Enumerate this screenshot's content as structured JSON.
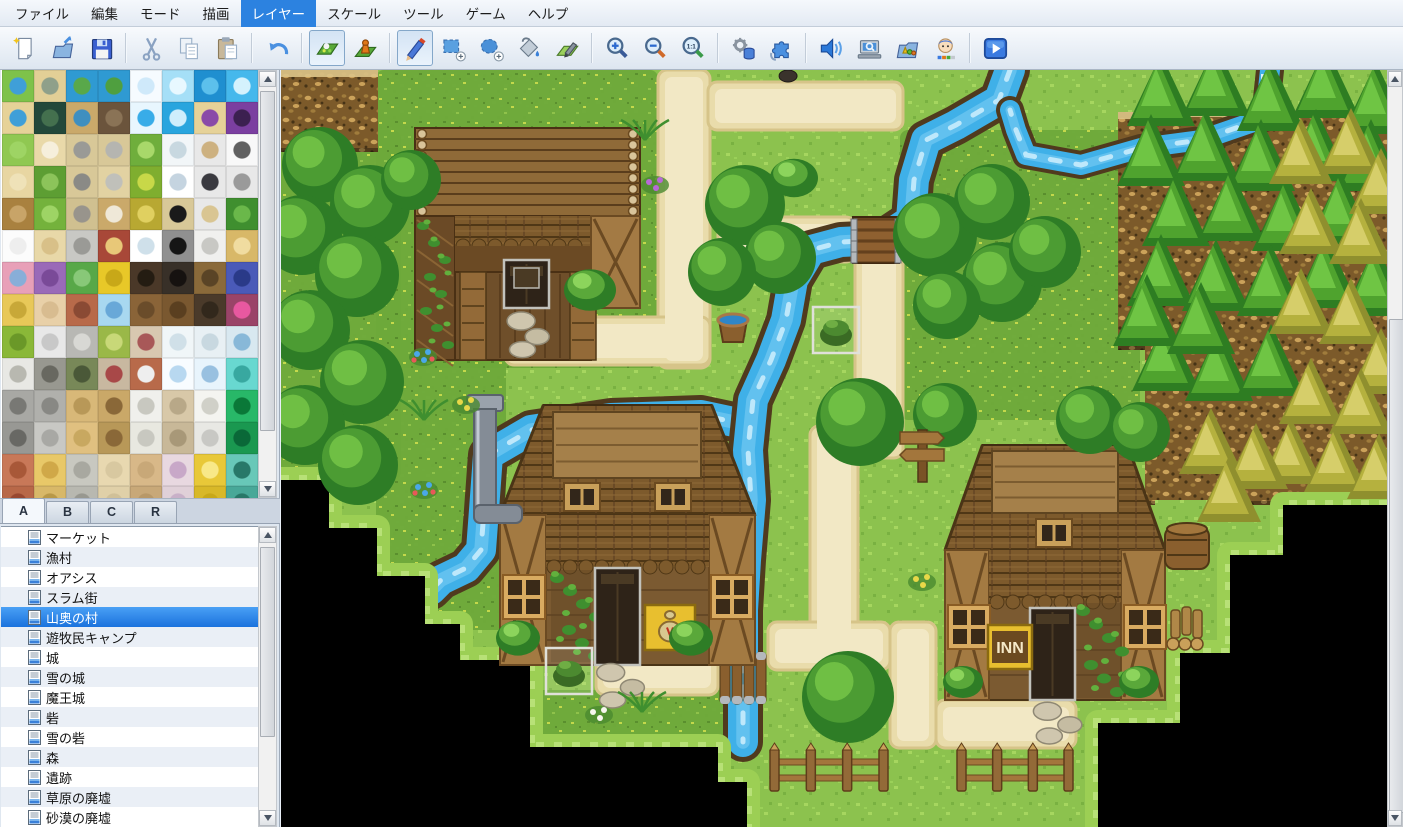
{
  "menu": {
    "items": [
      {
        "label": "ファイル",
        "active": false
      },
      {
        "label": "編集",
        "active": false
      },
      {
        "label": "モード",
        "active": false
      },
      {
        "label": "描画",
        "active": false
      },
      {
        "label": "レイヤー",
        "active": true
      },
      {
        "label": "スケール",
        "active": false
      },
      {
        "label": "ツール",
        "active": false
      },
      {
        "label": "ゲーム",
        "active": false
      },
      {
        "label": "ヘルプ",
        "active": false
      }
    ]
  },
  "toolbar": {
    "groups": [
      [
        "new-project",
        "open-project",
        "save-project"
      ],
      [
        "cut",
        "copy",
        "paste"
      ],
      [
        "undo"
      ],
      [
        "map-mode",
        "event-mode"
      ],
      [
        "pencil",
        "rect-select",
        "ellipse-select",
        "flood-fill",
        "shadow-pen"
      ],
      [
        "zoom-in",
        "zoom-out",
        "zoom-actual"
      ],
      [
        "database",
        "plugin-manager"
      ],
      [
        "sound-test",
        "event-search",
        "resource-manager",
        "character-generator"
      ],
      [
        "playtest"
      ]
    ],
    "pressed": [
      "map-mode",
      "pencil"
    ],
    "accent_color": "#2c82e0"
  },
  "palette": {
    "tabs": [
      {
        "label": "A",
        "active": true
      },
      {
        "label": "B",
        "active": false
      },
      {
        "label": "C",
        "active": false
      },
      {
        "label": "R",
        "active": false
      }
    ],
    "tiles": [
      [
        "#7ec24a|#3f9fd8",
        "#e2cf96|#8fa08a",
        "#2f9ad2|#59a84a",
        "#2f9ad2|#4f9f3f",
        "#f6fbff|#cfe9fa",
        "#a5dff7|#e8f8ff",
        "#1f8fd0|#5cc0ec",
        "#45b8ec|#d4f2fd"
      ],
      [
        "#e6d298|#3f9fd8",
        "#23483a|#44704e",
        "#caa96a|#3f8fc0",
        "#6b543c|#8a7356",
        "#e8f6fe|#38ace8",
        "#29a5de|#cfeefc",
        "#e6d298|#8a4aa8",
        "#7b3fa0|#3c2050"
      ],
      [
        "#90c852|#9ed464",
        "#e9d9a9|#f6efdc",
        "#d8c898|#9a9a96",
        "#d8c898|#b5b5b0",
        "#6fae3c|#a8d86a",
        "#f2f6f8|#c8d8e0",
        "#e8e8e8|#cdb180",
        "#f8f8f8|#606060"
      ],
      [
        "#e8d6a2|#efe2b8",
        "#5d9e33|#8cc45a",
        "#d8c898|#8a8a86",
        "#e2d2a2|#c0c0ba",
        "#7fae2f|#c8d848",
        "#ffffff|#c5d4e0",
        "#e8e8e8|#3a3a40",
        "#e8e8e8|#9a9a9a"
      ],
      [
        "#a9813f|#c8a468",
        "#74b23c|#9ed465",
        "#d0c090|#98948c",
        "#caa96a|#efe8d8",
        "#b8a832|#e0d060",
        "#d8c898|#1a1a1a",
        "#e8e8e8|#d9c592",
        "#3f8f2f|#6ab84a"
      ],
      [
        "#fcfcfc|#eeeeee",
        "#e8d8a8|#d8c088",
        "#c8c8c4|#9a9a96",
        "#a84838|#e8c878",
        "#ffffff|#cfe0ea",
        "#909090|#151515",
        "#f0f0ee|#c8c8c4",
        "#d8b868|#f0dca0"
      ],
      [
        "#e8a0b8|#88aed8",
        "#9a6ab8|#7a4a98",
        "#58a848|#88c878",
        "#e8c828|#c8a818",
        "#4a3828|#241c12",
        "#383028|#161210",
        "#8a6a3a|#5a4426",
        "#4a5ab8|#2a3a88"
      ],
      [
        "#e8c858|#c8a838",
        "#e8d0a8|#d8bc90",
        "#b86a4a|#8a4a34",
        "#a8d8f0|#68a8d8",
        "#8a6438|#6a4c2a",
        "#7a5830|#5a3f20",
        "#4a3a2a|#32281c",
        "#9a4468|#e858a0"
      ],
      [
        "#8ab838|#6a9828",
        "#e8e8e8|#c8c8c8",
        "#b8b8b4|#d8d8d4",
        "#9ab848|#c8d878",
        "#d8c8b0|#a85858",
        "#f0f6f8|#d0e0e8",
        "#e8f0f4|#c8d8e0",
        "#d8e8f0|#88b8d8"
      ],
      [
        "#e8e8e4|#b8b8b0",
        "#989890|#686860",
        "#788858|#4a5838",
        "#c8b8a0|#a84848",
        "#b86a4a|#eeeeee",
        "#f8fcff|#b8d8f0",
        "#e8f4fc|#98c0e0",
        "#68d8d0|#38a8a0"
      ],
      [
        "#a8a8a4|#787874",
        "#b0b0ac|#888884",
        "#d8b878|#b89858",
        "#caa868|#8a6838",
        "#f0f0ec|#c8c8c0",
        "#d8c8a8|#b8a888",
        "#f4f4f0|#d0d0c8",
        "#28b868|#0a7838"
      ],
      [
        "#989894|#686864",
        "#c8c8c4|#a8a8a4",
        "#e0c080|#c8a860",
        "#b89858|#8a6838",
        "#e8e8e0|#c8c8c0",
        "#c8b898|#a89878",
        "#e8e8e4|#c8c8c4",
        "#1a9850|#0a6838"
      ],
      [
        "#c87858|#a85838",
        "#e8c868|#d0a848",
        "#c8c8c0|#a8a8a0",
        "#e8d8b0|#d8c8a0",
        "#d8b888|#c8a878",
        "#e8d8e0|#c8a8c8",
        "#e8c838|#f8e888",
        "#68c8b8|#287868"
      ],
      [
        "#b86848|#984830",
        "#d8b868|#b89848",
        "#b8b8b0|#989890",
        "#e0d0a8|#d0c098",
        "#c8a878|#b89868",
        "#e0d0d8|#c8b0c8",
        "#d8b828|#c8a818",
        "#48a898|#287868"
      ]
    ]
  },
  "map_list": {
    "items": [
      {
        "label": "マーケット",
        "selected": false
      },
      {
        "label": "漁村",
        "selected": false
      },
      {
        "label": "オアシス",
        "selected": false
      },
      {
        "label": "スラム街",
        "selected": false
      },
      {
        "label": "山奥の村",
        "selected": true
      },
      {
        "label": "遊牧民キャンプ",
        "selected": false
      },
      {
        "label": "城",
        "selected": false
      },
      {
        "label": "雪の城",
        "selected": false
      },
      {
        "label": "魔王城",
        "selected": false
      },
      {
        "label": "砦",
        "selected": false
      },
      {
        "label": "雪の砦",
        "selected": false
      },
      {
        "label": "森",
        "selected": false
      },
      {
        "label": "遺跡",
        "selected": false
      },
      {
        "label": "草原の廃墟",
        "selected": false
      },
      {
        "label": "砂漠の廃墟",
        "selected": false
      }
    ]
  },
  "canvas": {
    "current_map": "山奥の村",
    "scene": {
      "colors": {
        "grass": "#8cc24e",
        "meadow": "#6da93a",
        "path": "#e9dcab",
        "path_light": "#f2e8c5",
        "water": "#3fb0e8",
        "bank": "#503a1e",
        "cliff": "#7c5a2a",
        "black": "#000000"
      },
      "meadows": [
        [
          95,
          0,
          282,
          298
        ],
        [
          95,
          270,
          130,
          290
        ],
        [
          250,
          620,
          215,
          57
        ],
        [
          619,
          60,
          240,
          290
        ],
        [
          874,
          525,
          75,
          58
        ],
        [
          0,
          60,
          120,
          350
        ]
      ],
      "cliffs": [
        [
          0,
          0,
          97,
          82
        ],
        [
          837,
          42,
          42,
          238
        ],
        [
          864,
          40,
          242,
          395
        ]
      ],
      "grass_patches": [
        [
          874,
          430,
          75,
          153
        ]
      ],
      "paths": [
        [
          377,
          0,
          52,
          298
        ],
        [
          427,
          12,
          195,
          48
        ],
        [
          224,
          247,
          205,
          48
        ],
        [
          437,
          147,
          137,
          45
        ],
        [
          574,
          178,
          48,
          210
        ],
        [
          529,
          356,
          48,
          242
        ],
        [
          315,
          577,
          122,
          48
        ],
        [
          487,
          552,
          122,
          48
        ],
        [
          609,
          552,
          46,
          126
        ],
        [
          655,
          630,
          140,
          48
        ]
      ],
      "rivers": {
        "main": [
          [
            729,
            0
          ],
          [
            718,
            30
          ],
          [
            675,
            55
          ],
          [
            645,
            70
          ],
          [
            633,
            110
          ],
          [
            630,
            150
          ],
          [
            600,
            170
          ],
          [
            560,
            172
          ],
          [
            530,
            180
          ],
          [
            512,
            210
          ],
          [
            505,
            250
          ],
          [
            490,
            290
          ],
          [
            472,
            330
          ],
          [
            467,
            380
          ],
          [
            470,
            430
          ],
          [
            465,
            490
          ],
          [
            462,
            540
          ],
          [
            462,
            600
          ],
          [
            462,
            672
          ]
        ],
        "west": [
          [
            467,
            355
          ],
          [
            420,
            345
          ],
          [
            330,
            348
          ],
          [
            250,
            360
          ],
          [
            207,
            385
          ],
          [
            203,
            440
          ],
          [
            200,
            480
          ],
          [
            185,
            498
          ],
          [
            160,
            510
          ],
          [
            150,
            520
          ]
        ],
        "plateau": [
          [
            989,
            0
          ],
          [
            984,
            48
          ],
          [
            920,
            70
          ],
          [
            860,
            78
          ],
          [
            800,
            95
          ],
          [
            745,
            85
          ],
          [
            735,
            60
          ],
          [
            729,
            40
          ]
        ]
      },
      "bridge": [
        572,
        147,
        46,
        46
      ],
      "dam": [
        437,
        582,
        50,
        52
      ],
      "steps_left": [
        [
          0,
          410
        ],
        [
          48,
          410
        ],
        [
          48,
          458
        ],
        [
          96,
          458
        ],
        [
          96,
          506
        ],
        [
          144,
          506
        ],
        [
          144,
          554
        ],
        [
          179,
          554
        ],
        [
          179,
          590
        ],
        [
          249,
          590
        ],
        [
          249,
          677
        ],
        [
          437,
          677
        ],
        [
          437,
          712
        ],
        [
          466,
          712
        ],
        [
          466,
          757
        ]
      ],
      "steps_right": [
        [
          1106,
          435
        ],
        [
          1002,
          435
        ],
        [
          1002,
          485
        ],
        [
          949,
          485
        ],
        [
          949,
          583
        ],
        [
          899,
          583
        ],
        [
          899,
          653
        ],
        [
          817,
          653
        ],
        [
          817,
          757
        ]
      ],
      "houses": [
        {
          "type": "cabin",
          "x": 134,
          "y": 58,
          "w": 225,
          "h": 232,
          "door": [
            223,
            190,
            45,
            48
          ]
        },
        {
          "type": "big",
          "x": 219,
          "y": 335,
          "w": 255,
          "rh": 110,
          "wh": 150,
          "ridge": [
            272,
            342,
            148,
            66
          ],
          "dormers": [
            [
              283,
              413
            ],
            [
              374,
              413
            ]
          ],
          "windows": [
            [
              222,
              505
            ],
            [
              430,
              505
            ]
          ],
          "door": [
            314,
            498,
            45,
            97
          ],
          "sign": {
            "kind": "bag",
            "box": [
              364,
              535,
              50,
              45
            ]
          },
          "vine": [
            270,
            500,
            40,
            92
          ],
          "panels": [
            [
              219,
              445
            ],
            [
              428,
              445
            ]
          ],
          "panelW": 46
        },
        {
          "type": "big",
          "x": 664,
          "y": 375,
          "w": 220,
          "rh": 105,
          "wh": 150,
          "ridge": [
            711,
            381,
            126,
            62
          ],
          "dormers": [
            [
              755,
              449
            ]
          ],
          "windows": [
            [
              667,
              535
            ],
            [
              843,
              535
            ]
          ],
          "door": [
            749,
            538,
            45,
            92
          ],
          "sign": {
            "kind": "text",
            "label": "INN",
            "box": [
              707,
              555,
              44,
              44
            ]
          },
          "vine": [
            796,
            533,
            44,
            95
          ],
          "panels": [
            [
              664,
              480
            ],
            [
              840,
              480
            ]
          ],
          "panelW": 44
        }
      ],
      "trees_round": [
        [
          39,
          95,
          38
        ],
        [
          89,
          135,
          40
        ],
        [
          21,
          165,
          40
        ],
        [
          76,
          205,
          42
        ],
        [
          29,
          260,
          40
        ],
        [
          81,
          312,
          42
        ],
        [
          24,
          355,
          40
        ],
        [
          77,
          395,
          40
        ],
        [
          130,
          110,
          30
        ],
        [
          464,
          135,
          40
        ],
        [
          499,
          188,
          36
        ],
        [
          441,
          202,
          34
        ],
        [
          654,
          165,
          42
        ],
        [
          711,
          132,
          38
        ],
        [
          721,
          212,
          40
        ],
        [
          666,
          235,
          34
        ],
        [
          764,
          182,
          36
        ],
        [
          579,
          352,
          44
        ],
        [
          809,
          350,
          34
        ],
        [
          859,
          362,
          30
        ],
        [
          664,
          345,
          32
        ],
        [
          567,
          627,
          46
        ]
      ],
      "trees_cone": [
        [
          880,
          30
        ],
        [
          935,
          20
        ],
        [
          990,
          35
        ],
        [
          1045,
          22
        ],
        [
          1095,
          38
        ],
        [
          870,
          90
        ],
        [
          925,
          85
        ],
        [
          980,
          95
        ],
        [
          1035,
          85
        ],
        [
          1090,
          95
        ],
        [
          895,
          150
        ],
        [
          950,
          145
        ],
        [
          1005,
          155
        ],
        [
          1060,
          148
        ],
        [
          880,
          210
        ],
        [
          935,
          215
        ],
        [
          990,
          220
        ],
        [
          1045,
          212
        ],
        [
          1095,
          220
        ],
        [
          885,
          295
        ],
        [
          938,
          305
        ],
        [
          990,
          300
        ],
        [
          866,
          250
        ],
        [
          920,
          258
        ]
      ],
      "trees_autumn": [
        [
          1020,
          90
        ],
        [
          1070,
          80
        ],
        [
          1100,
          120
        ],
        [
          1030,
          160
        ],
        [
          1080,
          170
        ],
        [
          1020,
          240
        ],
        [
          1070,
          250
        ],
        [
          1100,
          300
        ],
        [
          1030,
          330
        ],
        [
          1080,
          340
        ],
        [
          1010,
          390
        ],
        [
          1055,
          398
        ],
        [
          1098,
          405
        ],
        [
          930,
          380
        ],
        [
          975,
          395
        ],
        [
          948,
          428
        ]
      ],
      "bushes": [
        [
          237,
          568,
          22
        ],
        [
          410,
          568,
          22
        ],
        [
          682,
          612,
          20
        ],
        [
          858,
          612,
          20
        ],
        [
          513,
          108,
          24
        ],
        [
          309,
          220,
          26
        ]
      ],
      "flowers": [
        {
          "x": 142,
          "y": 287,
          "kind": "blue"
        },
        {
          "x": 143,
          "y": 420,
          "kind": "blue"
        },
        {
          "x": 185,
          "y": 335,
          "kind": "yellow"
        },
        {
          "x": 143,
          "y": 350,
          "kind": "fern"
        },
        {
          "x": 361,
          "y": 642,
          "kind": "fern"
        },
        {
          "x": 318,
          "y": 645,
          "kind": "white"
        },
        {
          "x": 641,
          "y": 512,
          "kind": "yellow"
        },
        {
          "x": 374,
          "y": 115,
          "kind": "purple"
        },
        {
          "x": 364,
          "y": 70,
          "kind": "fern"
        }
      ],
      "objects": {
        "bucket": [
          452,
          242
        ],
        "signpost": [
          619,
          357
        ],
        "barrel": [
          884,
          457
        ],
        "firewood": [
          884,
          498
        ],
        "pot": [
          499,
          0
        ],
        "chimney": [
          186,
          325
        ]
      },
      "fences": [
        [
          489,
          675,
          118
        ],
        [
          676,
          675,
          116
        ]
      ],
      "events": [
        [
          532,
          237
        ],
        [
          265,
          578
        ]
      ],
      "stones": [
        [
          224,
          238,
          46,
          52
        ],
        [
          308,
          590,
          62,
          50
        ],
        [
          744,
          630,
          64,
          45
        ]
      ]
    }
  }
}
